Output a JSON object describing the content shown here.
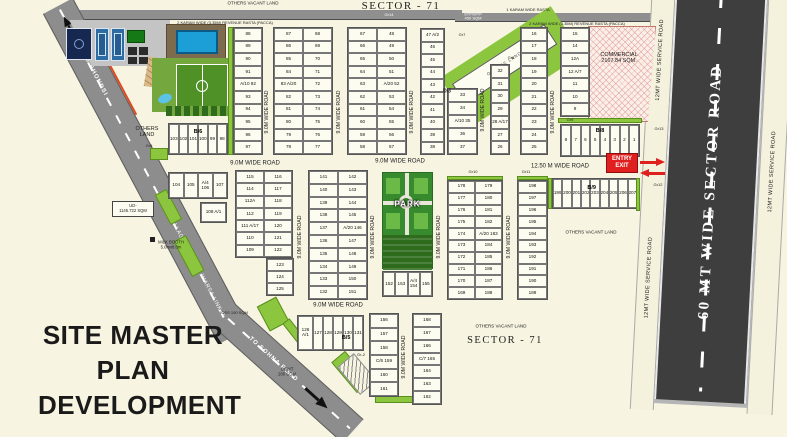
{
  "titles": {
    "site": [
      "SITE MASTER",
      "PLAN",
      "DEVELOPMENT"
    ],
    "sector_top": "SECTOR - 71",
    "sector_bottom": "SECTOR - 71"
  },
  "roads": {
    "nine_m": "9.0M WIDE ROAD",
    "twelve_fifty": "12.50 M WIDE ROAD",
    "sector_60": "60 MT WIDE SECTOR ROAD",
    "service_12": "12MT WIDE SERVICE ROAD",
    "to_bhondsi": "TO BHONDSI",
    "village_link": "VILLAGE FAZILPUR JHARSA LINK ROAD",
    "to_sohna": "TO SOHNA ROAD",
    "rasta_2karam": "2 KARAM WIDE (3.35M)  REVENUE RASTA (PACCA)",
    "rasta_1karam": "1 KARAM WIDE RASTA"
  },
  "labels": {
    "others_vacant_top": "OTHERS VACANT LAND",
    "others_vacant_mid": "OTHERS VACANT LAND",
    "others_vacant_bottom": "OTHERS VACANT LAND",
    "others_land_left": "OTHERS LAND",
    "others_land_diag": "OTHERS LAND",
    "commercial": "COMMERCIAL",
    "commercial_area": "2167.84 SQM.",
    "stp": "STP/WTP",
    "stp_area": "450 SQM",
    "ud": "UD-",
    "ud_area": "1145.722 SQM",
    "ugwt": "UGWT",
    "ugwt_area": "200 SQM",
    "ioss": "IOSS 100 SQM",
    "milk_booth": "MILK BOOTH",
    "milk_booth_size": "5.0mx8.0m",
    "park": "PARK",
    "entry": "ENTRY",
    "exit": "EXIT",
    "gr2": "Gr-2",
    "gr5": "Gr5",
    "gr7": "Gr7",
    "gr8": "Gr8",
    "gr9": "Gr9",
    "gr10": "Gr10",
    "gr11": "Gr11",
    "gr12": "Gr12",
    "gr13": "Gr13",
    "gr14": "Gr14",
    "d3": "D/3"
  },
  "plot_blocks": {
    "t1": {
      "cols": 1,
      "cells": [
        "88",
        "89",
        "90",
        "91",
        "A/10  92",
        "93",
        "94",
        "95",
        "96",
        "97"
      ]
    },
    "t2": {
      "cols": 2,
      "cells": [
        "87",
        "68",
        "86",
        "69",
        "85",
        "70",
        "84",
        "71",
        "83 A/20",
        "72",
        "82",
        "73",
        "81",
        "74",
        "80",
        "75",
        "79",
        "76",
        "78",
        "77"
      ]
    },
    "t3": {
      "cols": 2,
      "cells": [
        "67",
        "48",
        "66",
        "49",
        "65",
        "50",
        "64",
        "51",
        "63",
        "A/20 52",
        "62",
        "53",
        "61",
        "54",
        "60",
        "55",
        "59",
        "56",
        "58",
        "57"
      ]
    },
    "t4": {
      "cols": 1,
      "cells": [
        "47 A/2",
        "46",
        "45",
        "44",
        "43",
        "42",
        "41",
        "40",
        "39",
        "38"
      ]
    },
    "t5": {
      "cols": 1,
      "cells": [
        "33",
        "34",
        "A/10 35",
        "36",
        "37"
      ]
    },
    "t6": {
      "cols": 1,
      "cells": [
        "32",
        "31",
        "30",
        "29",
        "28 A/17",
        "27",
        "26"
      ]
    },
    "t7": {
      "cols": 1,
      "cells": [
        "16",
        "17",
        "18",
        "19",
        "20",
        "21",
        "22",
        "23",
        "24",
        "25"
      ]
    },
    "t8": {
      "cols": 1,
      "cells": [
        "15",
        "14",
        "12A",
        "12 A/7",
        "11",
        "10",
        "9"
      ]
    },
    "b8": {
      "cols": 8,
      "label": "B/8",
      "cells": [
        "8",
        "7",
        "6",
        "5",
        "4",
        "3",
        "2",
        "1"
      ]
    },
    "b6": {
      "cols": 6,
      "label": "B/6",
      "cells": [
        "103",
        "102",
        "101",
        "100",
        "99",
        "98"
      ]
    },
    "m1": {
      "cols": 4,
      "cells": [
        "104",
        "105",
        "A/4 106",
        "107"
      ]
    },
    "m2": {
      "cols": 1,
      "cells": [
        "108 A/1"
      ]
    },
    "m3": {
      "cols": 2,
      "cells": [
        "115",
        "116",
        "114",
        "117",
        "112A",
        "118",
        "112",
        "119",
        "111 A/17",
        "120",
        "110",
        "121",
        "109",
        "122"
      ]
    },
    "m3x": {
      "cols": 1,
      "cells": [
        "123",
        "124",
        "125"
      ]
    },
    "m4": {
      "cols": 2,
      "cells": [
        "141",
        "142",
        "140",
        "143",
        "139",
        "144",
        "138",
        "145",
        "137",
        "A/20 146",
        "136",
        "147",
        "135",
        "148",
        "134",
        "149",
        "133",
        "150",
        "132",
        "151"
      ]
    },
    "m5": {
      "cols": 4,
      "cells": [
        "152",
        "153",
        "A/4 154",
        "155"
      ]
    },
    "m6": {
      "cols": 2,
      "cells": [
        "178",
        "179",
        "177",
        "180",
        "176",
        "181",
        "175",
        "182",
        "174",
        "A/20 183",
        "173",
        "184",
        "172",
        "185",
        "171",
        "186",
        "170",
        "187",
        "169",
        "188"
      ]
    },
    "m7": {
      "cols": 1,
      "cells": [
        "198",
        "197",
        "196",
        "195",
        "194",
        "193",
        "192",
        "191",
        "190",
        "189"
      ]
    },
    "b9": {
      "cols": 9,
      "label": "B/9",
      "cells": [
        "199",
        "200",
        "201",
        "202",
        "203",
        "204",
        "205",
        "206",
        "207"
      ]
    },
    "m8": {
      "cols": 6,
      "label": "B/5",
      "template": "1.5fr 1fr 1fr 1fr 1fr 1fr",
      "cells": [
        "126 A/1",
        "127",
        "128",
        "129",
        "130",
        "131"
      ]
    },
    "m9": {
      "cols": 1,
      "cells": [
        "156",
        "157",
        "158",
        "C/6 159",
        "160",
        "161"
      ]
    },
    "m10": {
      "cols": 1,
      "cells": [
        "168",
        "167",
        "166",
        "C/7 165",
        "164",
        "163",
        "162"
      ]
    }
  }
}
